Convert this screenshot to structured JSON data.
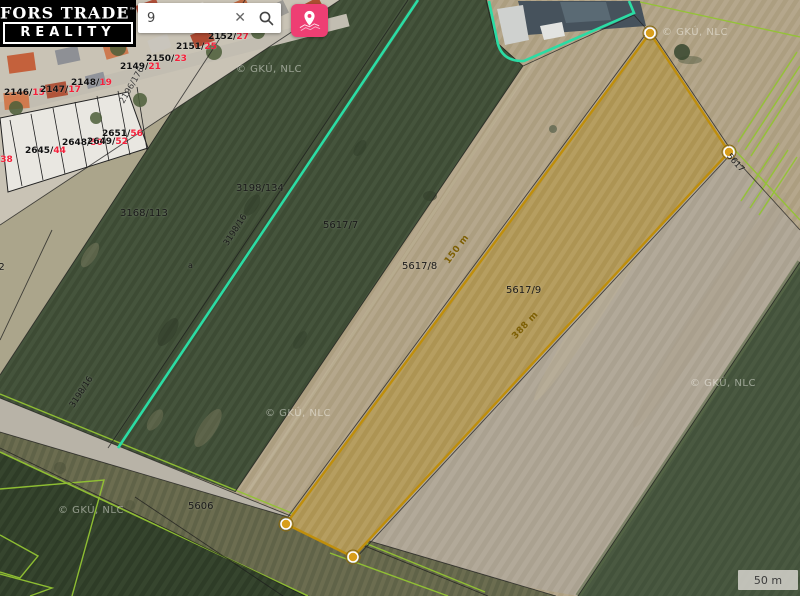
{
  "app": {
    "logo": {
      "line1": "FORS TRADE",
      "trademark": "™",
      "line2": "REALITY"
    },
    "search": {
      "value": "9",
      "clear_glyph": "✕"
    }
  },
  "map": {
    "attribution": "© GKÚ, NLC",
    "attribution_positions": [
      {
        "x": 236,
        "y": 64
      },
      {
        "x": 662,
        "y": 27
      },
      {
        "x": 265,
        "y": 408
      },
      {
        "x": 690,
        "y": 378
      },
      {
        "x": 58,
        "y": 505
      }
    ],
    "scale_bar": {
      "label": "50 m"
    },
    "parcel_labels": [
      {
        "text": "3198/134",
        "x": 236,
        "y": 183
      },
      {
        "text": "3168/113",
        "x": 120,
        "y": 208
      },
      {
        "text": "5617/7",
        "x": 323,
        "y": 220
      },
      {
        "text": "5617/8",
        "x": 402,
        "y": 261
      },
      {
        "text": "5617/9",
        "x": 506,
        "y": 285
      },
      {
        "text": "5606",
        "x": 188,
        "y": 501
      },
      {
        "text": "12",
        "x": -8,
        "y": 262
      },
      {
        "text": "a",
        "x": 188,
        "y": 261,
        "size": 8
      },
      {
        "text": "3198/16",
        "x": 226,
        "y": 240,
        "rot": -57,
        "size": 8.5
      },
      {
        "text": "3198/16",
        "x": 72,
        "y": 402,
        "rot": -57,
        "size": 8.5
      },
      {
        "text": "5617",
        "x": 728,
        "y": 150,
        "rot": 48,
        "size": 8.5
      },
      {
        "text": "2196/176",
        "x": 122,
        "y": 98,
        "rot": -60,
        "size": 8.5,
        "color": "#3a3a3a"
      }
    ],
    "measure_labels": [
      {
        "text": "150 m",
        "x": 447,
        "y": 258,
        "rot": -53
      },
      {
        "text": "388 m",
        "x": 514,
        "y": 333,
        "rot": -47
      }
    ],
    "house_labels": [
      {
        "main": "2146/",
        "num": "15",
        "x": 4,
        "y": 88
      },
      {
        "main": "2147/",
        "num": "17",
        "x": 40,
        "y": 85
      },
      {
        "main": "2148/",
        "num": "19",
        "x": 71,
        "y": 78
      },
      {
        "main": "2149/",
        "num": "21",
        "x": 120,
        "y": 62
      },
      {
        "main": "2150/",
        "num": "23",
        "x": 146,
        "y": 54
      },
      {
        "main": "2151/",
        "num": "25",
        "x": 176,
        "y": 42
      },
      {
        "main": "2152/",
        "num": "27",
        "x": 208,
        "y": 32
      },
      {
        "main": "2651/",
        "num": "56",
        "x": 102,
        "y": 129
      },
      {
        "main": "2648/",
        "num": "50",
        "x": 62,
        "y": 138
      },
      {
        "main": "2649/",
        "num": "52",
        "x": 87,
        "y": 137
      },
      {
        "main": "2645/",
        "num": "44",
        "x": 25,
        "y": 146
      },
      {
        "main": "/",
        "num": "38",
        "x": -3,
        "y": 155
      }
    ],
    "colors": {
      "selection_teal": "#2bdca4",
      "selection_gold": "#bf8e0b",
      "brand_pink": "#ee3e73",
      "house_number_red": "#f5203a"
    }
  }
}
